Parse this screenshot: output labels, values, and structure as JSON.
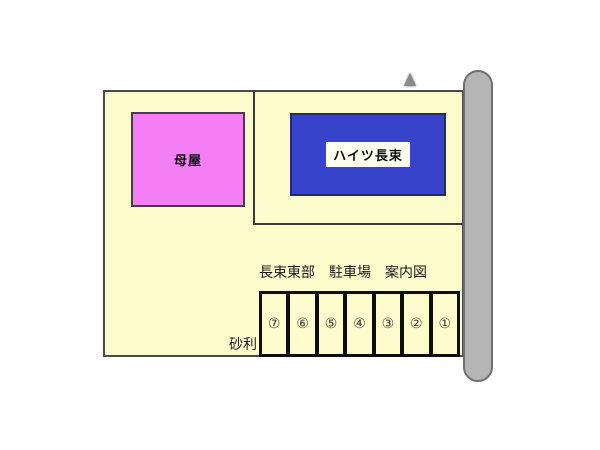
{
  "map": {
    "title": "長束東部　駐車場　案内図",
    "ground_label": "砂利",
    "buildings": {
      "main_house": {
        "label": "母屋",
        "fill": "#F47FF4"
      },
      "apartment": {
        "label": "ハイツ長束",
        "fill": "#3743CB"
      }
    },
    "parcel": {
      "fill": "#FBFBCC"
    },
    "road": {
      "fill": "#B5B5B5"
    },
    "parking": {
      "stalls": [
        {
          "number": "⑦"
        },
        {
          "number": "⑥"
        },
        {
          "number": "⑤"
        },
        {
          "number": "④"
        },
        {
          "number": "③"
        },
        {
          "number": "②"
        },
        {
          "number": "①"
        }
      ]
    }
  }
}
